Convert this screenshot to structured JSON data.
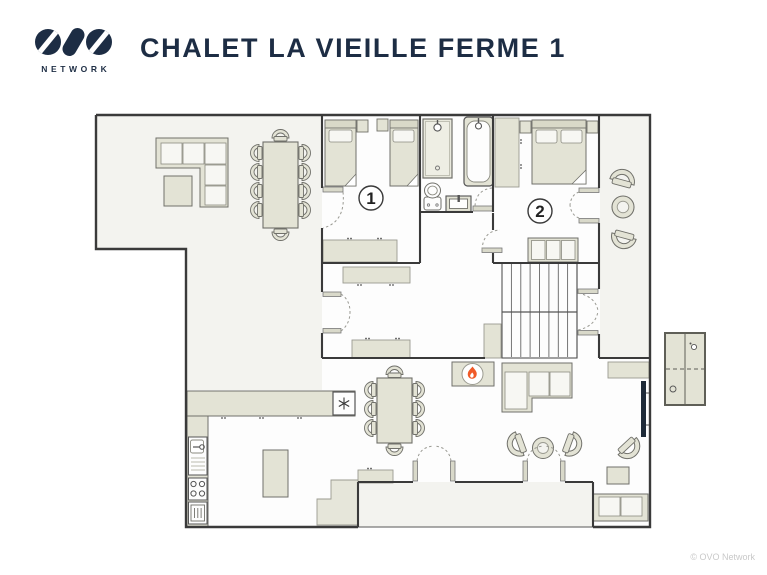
{
  "header": {
    "logo": {
      "icon": "ovo-logo-mark",
      "wordmark": "NETWORK"
    },
    "title": "CHALET LA VIEILLE FERME 1"
  },
  "floorplan": {
    "rooms": [
      {
        "id": "bedroom-1",
        "label": "1"
      },
      {
        "id": "bedroom-2",
        "label": "2"
      }
    ],
    "fixtures": [
      "flame-icon",
      "snowflake-icon",
      "shower-icon",
      "bathtub-icon",
      "toilet-icon",
      "sink-icon",
      "stove-icon",
      "oven-icon",
      "tv-screen",
      "staircase",
      "wardrobe",
      "ping-pong-table"
    ],
    "colors": {
      "wall": "#3a3a3a",
      "furniture_fill": "#e3e3d5",
      "furniture_stroke": "#70706a",
      "floor": "#fdfdfd",
      "floor_shaded": "#f3f3ef",
      "flame": "#f05a28",
      "title_navy": "#1d2d44",
      "watermark": "#c9c9c9"
    }
  },
  "footer": {
    "watermark": "© OVO Network"
  }
}
